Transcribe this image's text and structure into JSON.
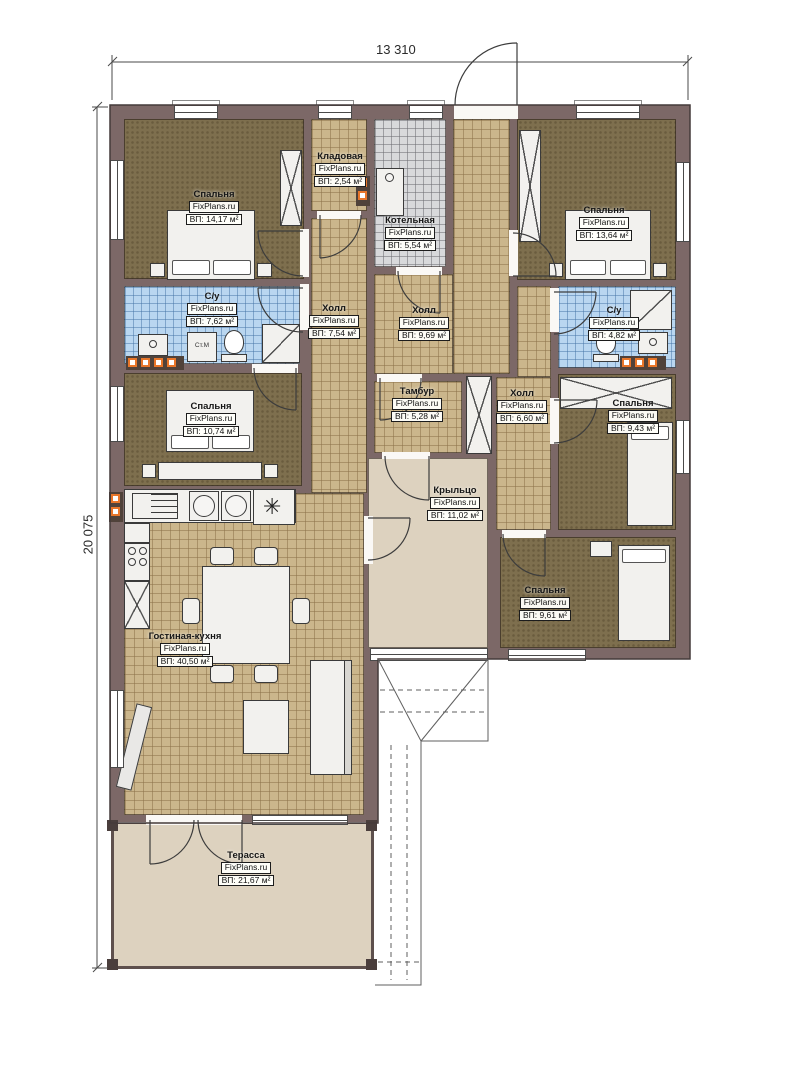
{
  "dimensions": {
    "width_label": "13 310",
    "height_label": "20 075"
  },
  "fixtures": {
    "washer_label": "Ст.М",
    "kitchen_unit_symbol": "✳"
  },
  "rooms": [
    {
      "id": "bedroom-top-left",
      "name": "Спальня",
      "brand": "FixPlans.ru",
      "area": "ВП: 14,17 м²"
    },
    {
      "id": "storage",
      "name": "Кладовая",
      "brand": "FixPlans.ru",
      "area": "ВП: 2,54 м²"
    },
    {
      "id": "boiler-room",
      "name": "Котельная",
      "brand": "FixPlans.ru",
      "area": "ВП: 5,54 м²"
    },
    {
      "id": "bedroom-top-right",
      "name": "Спальня",
      "brand": "FixPlans.ru",
      "area": "ВП: 13,64 м²"
    },
    {
      "id": "bathroom-left",
      "name": "С/у",
      "brand": "FixPlans.ru",
      "area": "ВП: 7,62 м²"
    },
    {
      "id": "hall-left",
      "name": "Холл",
      "brand": "FixPlans.ru",
      "area": "ВП: 7,54 м²"
    },
    {
      "id": "hall-center",
      "name": "Холл",
      "brand": "FixPlans.ru",
      "area": "ВП: 9,69 м²"
    },
    {
      "id": "bathroom-right",
      "name": "С/у",
      "brand": "FixPlans.ru",
      "area": "ВП: 4,82 м²"
    },
    {
      "id": "bedroom-mid-left",
      "name": "Спальня",
      "brand": "FixPlans.ru",
      "area": "ВП: 10,74 м²"
    },
    {
      "id": "vestibule",
      "name": "Тамбур",
      "brand": "FixPlans.ru",
      "area": "ВП: 5,28 м²"
    },
    {
      "id": "hall-right",
      "name": "Холл",
      "brand": "FixPlans.ru",
      "area": "ВП: 6,60 м²"
    },
    {
      "id": "bedroom-right",
      "name": "Спальня",
      "brand": "FixPlans.ru",
      "area": "ВП: 9,43 м²"
    },
    {
      "id": "porch",
      "name": "Крыльцо",
      "brand": "FixPlans.ru",
      "area": "ВП: 11,02 м²"
    },
    {
      "id": "bedroom-bottom-right",
      "name": "Спальня",
      "brand": "FixPlans.ru",
      "area": "ВП: 9,61 м²"
    },
    {
      "id": "living-kitchen",
      "name": "Гостиная-кухня",
      "brand": "FixPlans.ru",
      "area": "ВП: 40,50 м²"
    },
    {
      "id": "terrace",
      "name": "Терасса",
      "brand": "FixPlans.ru",
      "area": "ВП: 21,67 м²"
    }
  ]
}
